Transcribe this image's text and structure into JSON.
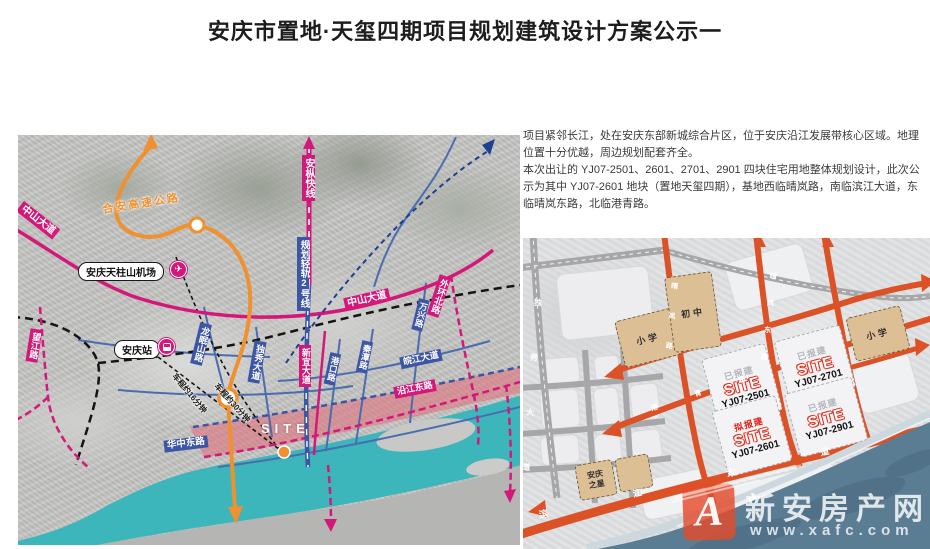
{
  "page": {
    "title": "安庆市置地·天玺四期项目规划建筑设计方案公示一"
  },
  "description": {
    "para1": "项目紧邻长江，处在安庆东部新城综合片区，位于安庆沿江发展带核心区域。地理位置十分优越，周边规划配套齐全。",
    "para2": "本次出让的 YJ07-2501、2601、2701、2901 四块住宅用地整体规划设计，此次公示为其中 YJ07-2601 地块（置地天玺四期），基地西临晴岚路，南临滨江大道，东临晴岚东路，北临港青路。"
  },
  "left_map": {
    "labels": {
      "zhongshan_nw": "中山大道",
      "hean_expressway": "合安高速公路",
      "airport": "安庆天柱山机场",
      "airport_icon": "✈",
      "anzong_express": "安枞快线",
      "rail_line2": "规划轻轨2号线",
      "station": "安庆站",
      "wangjiang_rd": "望江路",
      "longmianshan_rd": "龙眠山路",
      "duxiu_ave": "独秀大道",
      "drive_16": "车程约16分钟",
      "drive_30": "车程约30分钟",
      "zhongshan_c": "中山大道",
      "waihuan_north_rd": "外环北路",
      "wanxing_rd": "万兴路",
      "xinyi_ave": "新宜大道",
      "gangkou_rd": "港口路",
      "qintan_rd": "秦潭路",
      "wanjiang_ave": "皖江大道",
      "yanjiang_east_rd": "沿江东路",
      "huazhong_east_rd": "华中东路",
      "site": "SITE"
    }
  },
  "right_map": {
    "parcels": {
      "school_left": "小学",
      "middle_school": "初中",
      "school_right": "小学",
      "anqing_star": "安庆之星",
      "s2501": {
        "status": "已报建",
        "site": "SITE",
        "code": "YJ07-2501"
      },
      "s2701": {
        "status": "已报建",
        "site": "SITE",
        "code": "YJ07-2701"
      },
      "s2601": {
        "status": "拟报建",
        "site": "SITE",
        "code": "YJ07-2601"
      },
      "s2901": {
        "status": "已报建",
        "site": "SITE",
        "code": "YJ07-2901"
      }
    },
    "roads": {
      "duxiu_ave": "独秀大道",
      "binjiang_ave": "滨江大道",
      "qinglan_rd": "晴岚路",
      "qinglan_east_rd": "晴岚东路",
      "gangqing_rd": "港青路"
    }
  },
  "watermark": {
    "brand": "新安房产网",
    "url": "www.xafc.com",
    "monogram": "A"
  },
  "colors": {
    "magenta": "#d41879",
    "road_blue": "#3d55a5",
    "highway_orange": "#f0902e",
    "river_teal": "#3cb6ba",
    "planned_red": "#dc5126",
    "river_dark": "#5b7d93",
    "site_pink": "#e8828c"
  }
}
